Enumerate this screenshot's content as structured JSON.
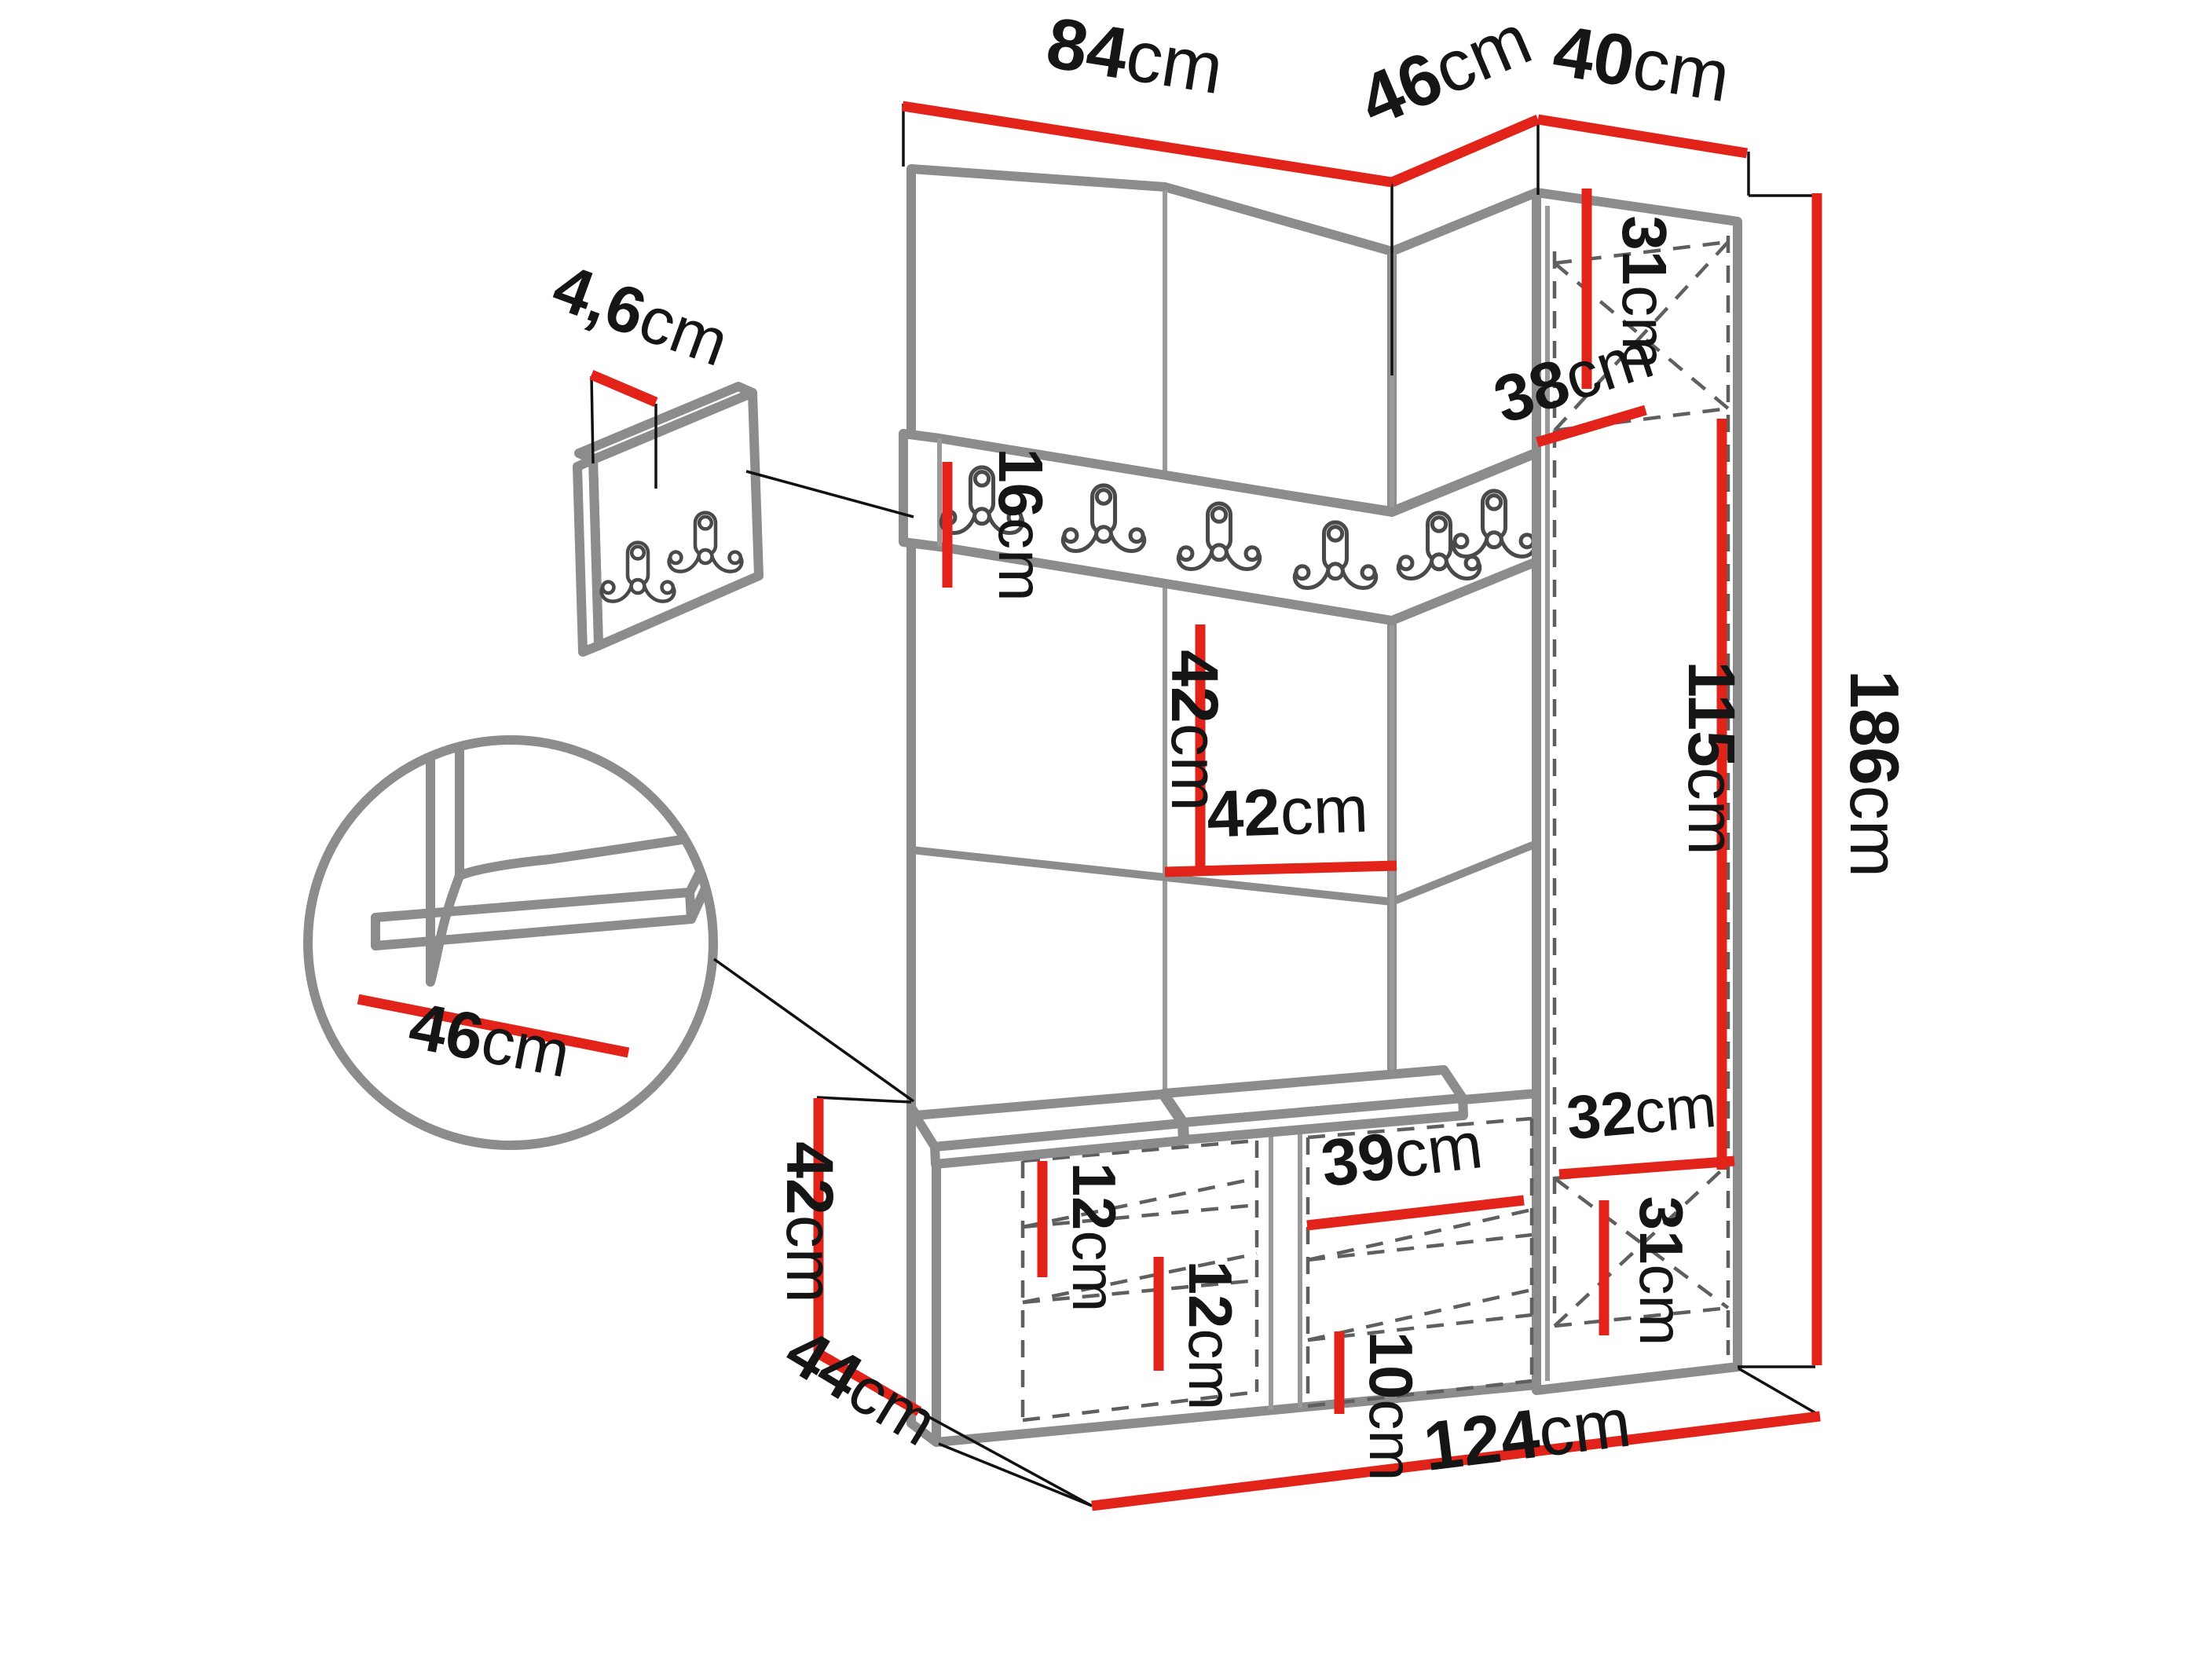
{
  "diagram": {
    "type": "furniture-dimension-diagram",
    "subject": "hallway corner wardrobe set with padded wall panels, hook rail, bench and tall cabinet",
    "units": "cm",
    "colors": {
      "dimension_line": "#e2231a",
      "outline": "#8c8c8c",
      "extension_line": "#111111",
      "hidden_line": "#5f5f5f",
      "background": "#ffffff"
    },
    "rail_hook_count": 6,
    "panel_hook_count": 2
  },
  "labels": {
    "top84": {
      "num": "84",
      "unit": "cm"
    },
    "top46": {
      "num": "46",
      "unit": "cm"
    },
    "top40": {
      "num": "40",
      "unit": "cm"
    },
    "thick46": {
      "num": "4,6",
      "unit": "cm"
    },
    "rail16": {
      "num": "16",
      "unit": "cm"
    },
    "up31": {
      "num": "31",
      "unit": "cm"
    },
    "depth38": {
      "num": "38",
      "unit": "cm"
    },
    "pan42v": {
      "num": "42",
      "unit": "cm"
    },
    "pan42h": {
      "num": "42",
      "unit": "cm"
    },
    "hang115": {
      "num": "115",
      "unit": "cm"
    },
    "tot186": {
      "num": "186",
      "unit": "cm"
    },
    "seat46": {
      "num": "46",
      "unit": "cm"
    },
    "bench42": {
      "num": "42",
      "unit": "cm"
    },
    "depth44": {
      "num": "44",
      "unit": "cm"
    },
    "gap12a": {
      "num": "12",
      "unit": "cm"
    },
    "gap12b": {
      "num": "12",
      "unit": "cm"
    },
    "mid39": {
      "num": "39",
      "unit": "cm"
    },
    "gap10": {
      "num": "10",
      "unit": "cm"
    },
    "in32": {
      "num": "32",
      "unit": "cm"
    },
    "low31": {
      "num": "31",
      "unit": "cm"
    },
    "tot124": {
      "num": "124",
      "unit": "cm"
    }
  }
}
